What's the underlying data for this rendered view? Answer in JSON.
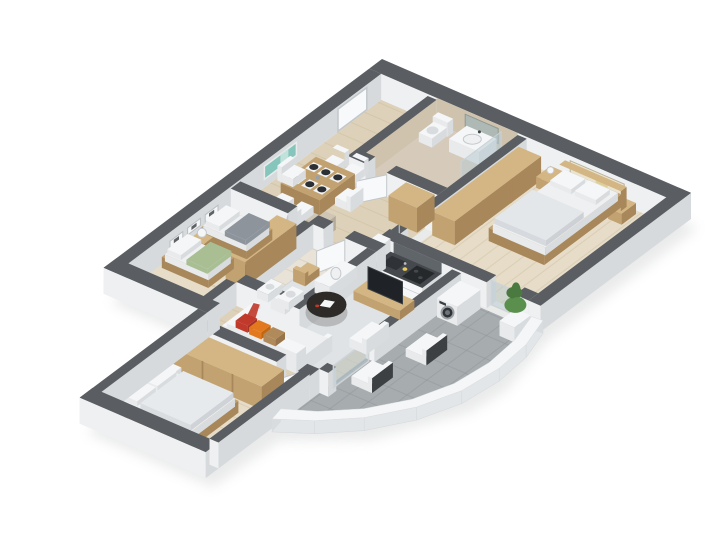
{
  "scene": {
    "type": "isometric-3d-apartment-floor-plan-render",
    "background": "#ffffff",
    "view": "cutaway-from-above"
  },
  "palette": {
    "wallTop": "#5a5e62",
    "wallLight": "#eef0f2",
    "wallShade": "#d7dadd",
    "bathWall": "#cfc3ae",
    "woodFloor": "#ddd1b9",
    "woodFloorLight": "#e6dcc7",
    "plank": "#c0ae8f",
    "tileBeige": "#d6cbbb",
    "tileLight": "#e8e2d7",
    "balconyFloor": "#a7acaf",
    "balconyLine": "#90959a",
    "rug": "#e0e3e5",
    "white": "#f5f6f7",
    "whiteSide": "#e8eaec",
    "whiteShade": "#d9dcdf",
    "mattress": "#eef0f2",
    "beddingGray": "#8e949c",
    "beddingGreen": "#a9bf93",
    "pillowRed": "#c0392b",
    "pillowOrange": "#e2791f",
    "pillowTan": "#b08a5a",
    "wood": "#c2a271",
    "woodDark": "#a8875a",
    "woodLight": "#d3b684",
    "counterTop": "#45494d",
    "counterDark": "#2f3337",
    "plate": "#2c2f33",
    "tv": "#1f2226",
    "glass": "rgba(183,203,212,0.5)",
    "door": "#f8f9fa",
    "doorFrame": "#c2c7cb",
    "mirror": "#aeb8b4",
    "artTeal": "#85c5bc",
    "artTealLight": "#cfe8e2",
    "artCream": "#eae3cf",
    "frameDark": "#3b3e41",
    "plant": "#5b8f4d",
    "plantDark": "#4a7a3f",
    "metal": "#3c4043",
    "backsplash": "#60656a",
    "parapetFace": "#e3e6e8",
    "shadowCol": "#c2c4c5"
  },
  "labels": {
    "building": "3d-apartment-floor-plan",
    "entry_hall": "entry-hall",
    "bathroom_top": "main-bathroom",
    "master_bedroom": "master-bedroom",
    "balcony": "balcony-terrace",
    "kitchen": "kitchen",
    "living_room": "living-room",
    "dining_area": "dining-area",
    "kids_bedroom": "kids-bedroom",
    "bathroom_lower": "second-bathroom",
    "bedroom_bottom": "third-bedroom"
  }
}
